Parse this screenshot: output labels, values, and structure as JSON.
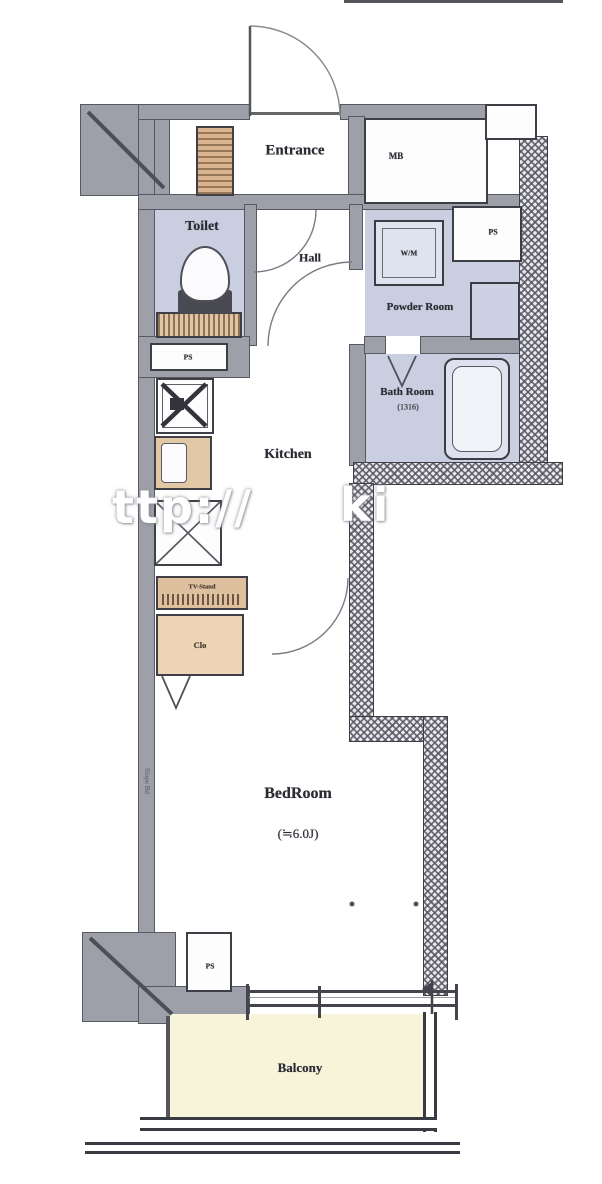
{
  "plan_title": "apartment-floor-plan",
  "rooms": {
    "entrance": {
      "label": "Entrance"
    },
    "mb": {
      "label": "MB"
    },
    "toilet": {
      "label": "Toilet"
    },
    "hall": {
      "label": "Hall"
    },
    "powder_room": {
      "label": "Powder Room"
    },
    "wm": {
      "label": "W/M"
    },
    "ps_top": {
      "label": "PS"
    },
    "ps_mid": {
      "label": "PS"
    },
    "ps_bottom": {
      "label": "PS"
    },
    "bath_room": {
      "label": "Bath Room",
      "size": "(1316)"
    },
    "kitchen": {
      "label": "Kitchen"
    },
    "storage": {
      "label": "TV-Stand"
    },
    "closet": {
      "label": "Clo"
    },
    "bedroom": {
      "label": "BedRoom",
      "size": "(≒6.0J)"
    },
    "balcony": {
      "label": "Balcony"
    },
    "wall_note": {
      "label": "Slope Bd"
    }
  },
  "watermark": {
    "left_fragment": "ttp://",
    "right_fragment": "ki"
  },
  "colors": {
    "wall_gray": "#9da0a8",
    "room_lavender": "#c9cfe0",
    "wood_tan": "#d9b48e",
    "closet_tan": "#ecd4b4",
    "balcony_cream": "#f8f4da",
    "line_dark": "#3e3e46"
  }
}
